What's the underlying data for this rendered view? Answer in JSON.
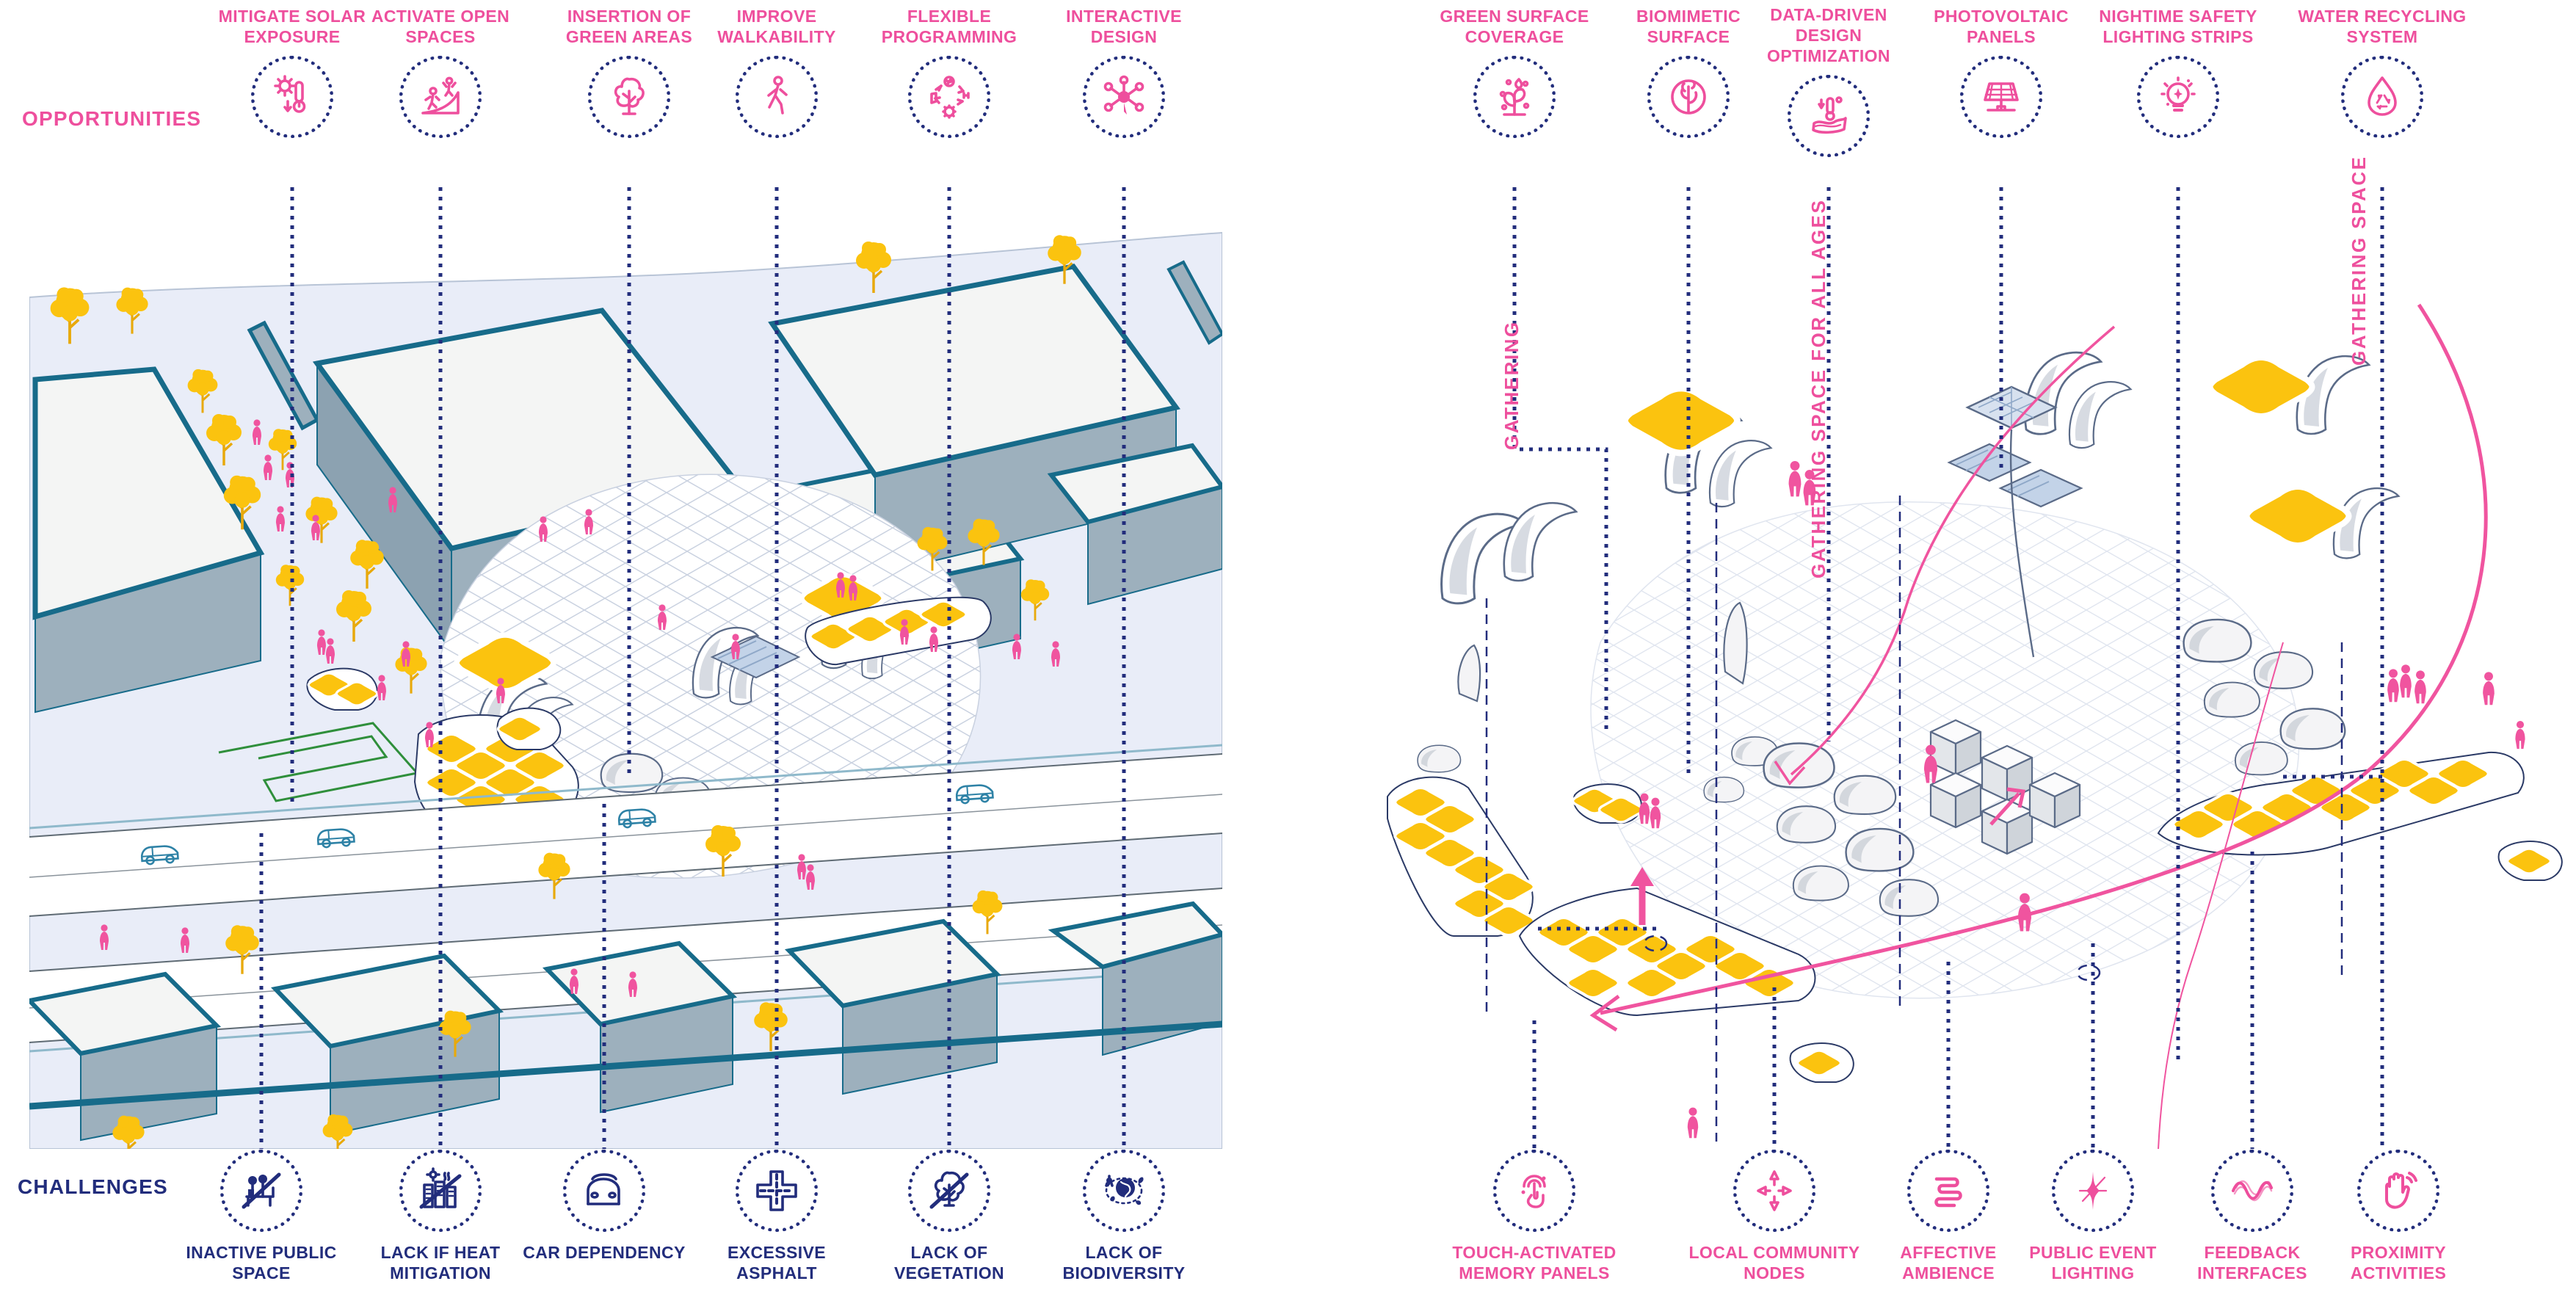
{
  "title": "Public space analysis and design proposal diagram",
  "colors": {
    "pink": "#EE4F9D",
    "navy": "#222D7C",
    "teal_outline": "#176B8A",
    "yellow": "#FBC30F",
    "building_top": "#F4F5F4",
    "building_side": "#9DB0BD",
    "ground": "#E9EDF8",
    "canopy_stroke": "#5B6B88",
    "path_green": "#2F8F3B",
    "water_blue": "#C3D3E8"
  },
  "left_panel": {
    "section_label": "OPPORTUNITIES",
    "section_label_bottom": "CHALLENGES",
    "opportunities": [
      {
        "label": "MITIGATE SOLAR EXPOSURE",
        "icon": "sun-thermometer-icon"
      },
      {
        "label": "ACTIVATE OPEN SPACES",
        "icon": "skate-ramp-icon"
      },
      {
        "label": "INSERTION OF GREEN AREAS",
        "icon": "tree-icon"
      },
      {
        "label": "IMPROVE WALKABILITY",
        "icon": "walking-person-icon"
      },
      {
        "label": "FLEXIBLE PROGRAMMING",
        "icon": "activity-cycle-icon"
      },
      {
        "label": "INTERACTIVE DESIGN",
        "icon": "interaction-network-icon"
      }
    ],
    "challenges": [
      {
        "label": "INACTIVE PUBLIC SPACE",
        "icon": "inactive-park-icon"
      },
      {
        "label": "LACK IF HEAT MITIGATION",
        "icon": "urban-heat-icon"
      },
      {
        "label": "CAR DEPENDENCY",
        "icon": "car-icon"
      },
      {
        "label": "EXCESSIVE ASPHALT",
        "icon": "road-cross-icon"
      },
      {
        "label": "LACK OF VEGETATION",
        "icon": "no-tree-icon"
      },
      {
        "label": "LACK OF BIODIVERSITY",
        "icon": "biodiversity-globe-icon"
      }
    ]
  },
  "right_panel": {
    "strategies": [
      {
        "label": "GREEN SURFACE COVERAGE",
        "icon": "plant-drops-icon"
      },
      {
        "label": "BIOMIMETIC SURFACE",
        "icon": "coral-icon"
      },
      {
        "label": "DATA-DRIVEN DESIGN OPTIMIZATION",
        "icon": "surface-thermometer-icon"
      },
      {
        "label": "PHOTOVOLTAIC PANELS",
        "icon": "solar-panel-icon"
      },
      {
        "label": "NIGHTIME SAFETY LIGHTING STRIPS",
        "icon": "light-bulb-icon"
      },
      {
        "label": "WATER RECYCLING SYSTEM",
        "icon": "water-recycle-icon"
      }
    ],
    "features": [
      {
        "label": "TOUCH-ACTIVATED MEMORY PANELS",
        "icon": "touch-panel-icon"
      },
      {
        "label": "LOCAL COMMUNITY NODES",
        "icon": "community-nodes-icon"
      },
      {
        "label": "AFFECTIVE AMBIENCE",
        "icon": "ambience-squiggle-icon"
      },
      {
        "label": "PUBLIC EVENT LIGHTING",
        "icon": "event-sparkle-icon"
      },
      {
        "label": "FEEDBACK INTERFACES",
        "icon": "feedback-wave-icon"
      },
      {
        "label": "PROXIMITY ACTIVITIES",
        "icon": "proximity-hand-icon"
      }
    ],
    "annotations": [
      {
        "label": "GATHERING"
      },
      {
        "label": "GATHERING SPACE FOR ALL AGES"
      },
      {
        "label": "GATHERING SPACE"
      }
    ]
  }
}
